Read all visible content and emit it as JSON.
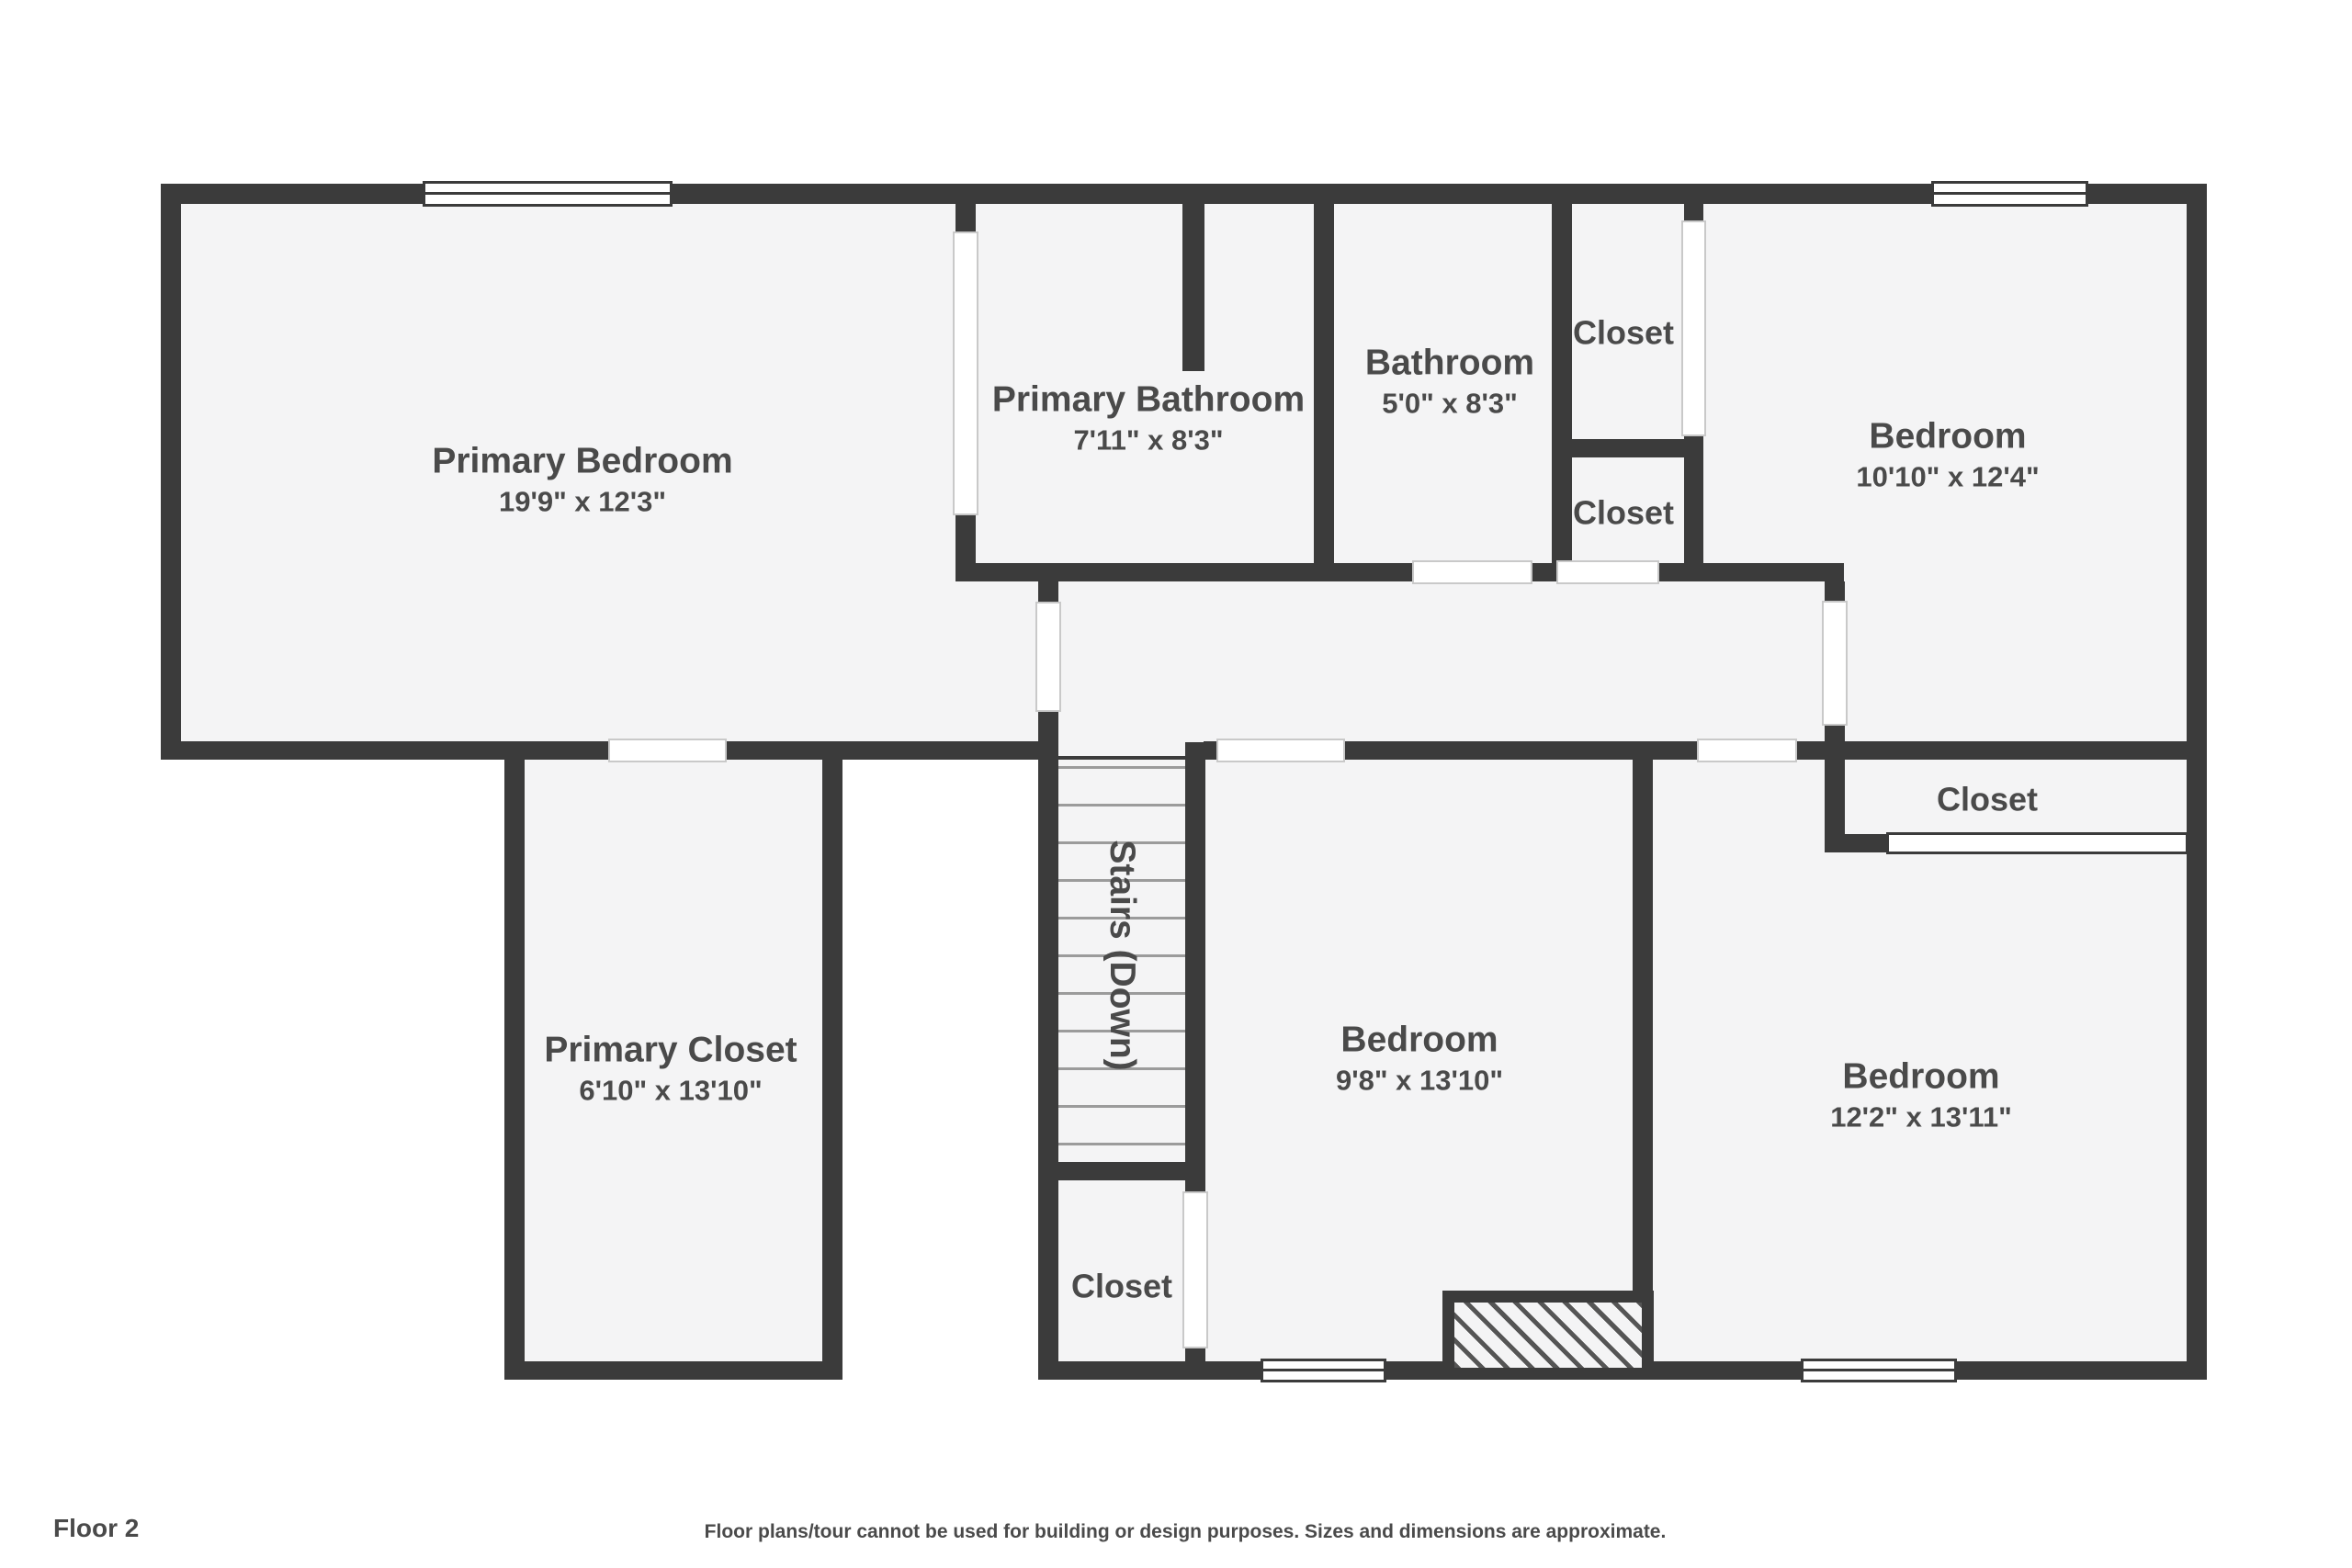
{
  "footer": {
    "floor_label": "Floor 2",
    "disclaimer": "Floor plans/tour cannot be used for building or design purposes. Sizes and dimensions are approximate."
  },
  "colors": {
    "wall": "#3b3b3b",
    "floor": "#f4f4f5",
    "text": "#4a4a4a",
    "tread": "#9b9b9b",
    "door_edge": "#c9c9c9",
    "background": "#ffffff"
  },
  "rooms": {
    "primary_bedroom": {
      "name": "Primary Bedroom",
      "dims": "19'9\" x 12'3\""
    },
    "primary_bathroom": {
      "name": "Primary Bathroom",
      "dims": "7'11\" x 8'3\""
    },
    "bathroom": {
      "name": "Bathroom",
      "dims": "5'0\" x 8'3\""
    },
    "closet_top": {
      "name": "Closet"
    },
    "closet_mid": {
      "name": "Closet"
    },
    "bedroom_top_right": {
      "name": "Bedroom",
      "dims": "10'10\" x 12'4\""
    },
    "closet_right": {
      "name": "Closet"
    },
    "primary_closet": {
      "name": "Primary Closet",
      "dims": "6'10\" x 13'10\""
    },
    "stairs": {
      "name": "Stairs (Down)"
    },
    "bedroom_middle": {
      "name": "Bedroom",
      "dims": "9'8\" x 13'10\""
    },
    "closet_bottom": {
      "name": "Closet"
    },
    "bedroom_right": {
      "name": "Bedroom",
      "dims": "12'2\" x 13'11\""
    }
  }
}
